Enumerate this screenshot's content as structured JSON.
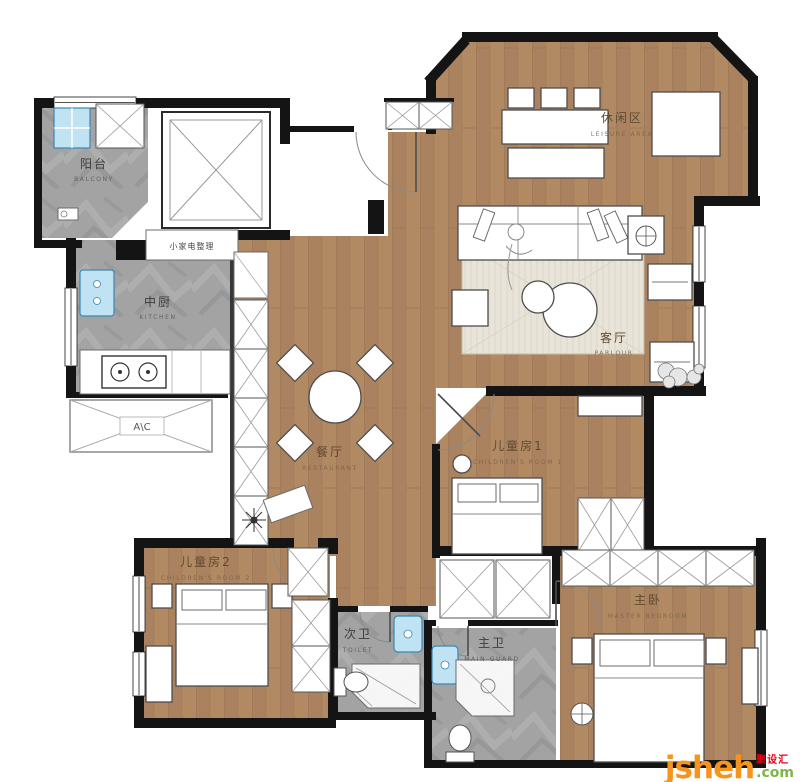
{
  "plan": {
    "rooms": {
      "balcony": {
        "zh": "阳台",
        "en": "BALCONY"
      },
      "kitchen": {
        "zh": "中厨",
        "en": "KITCHEN"
      },
      "leisure": {
        "zh": "休闲区",
        "en": "LEISURE AREA"
      },
      "parlour": {
        "zh": "客厅",
        "en": "PARLOUR"
      },
      "dining": {
        "zh": "餐厅",
        "en": "RESTAURANT"
      },
      "children1": {
        "zh": "儿童房1",
        "en": "CHILDREN'S ROOM 1"
      },
      "children2": {
        "zh": "儿童房2",
        "en": "CHILDREN'S ROOM 2"
      },
      "toilet": {
        "zh": "次卫",
        "en": "TOILET"
      },
      "master_bath": {
        "zh": "主卫",
        "en": "MAIN GUARD"
      },
      "master": {
        "zh": "主卧",
        "en": "MASTER BEDROOM"
      }
    },
    "annotations": {
      "ac": "A\\C",
      "appliance_cabinet": "小家电整理"
    },
    "colors": {
      "wood_floor": "#b18a63",
      "stone_floor": "#a2a2a2",
      "wall": "#141414",
      "rug": "#e9e4d9",
      "fixture_blue": "#bfe3f2",
      "logo_orange": "#f7941e",
      "logo_red": "#e60012",
      "logo_green": "#7ab648"
    }
  },
  "watermark": {
    "brand": "jsheh",
    "cn": "聚设汇",
    "tld": ".com"
  }
}
